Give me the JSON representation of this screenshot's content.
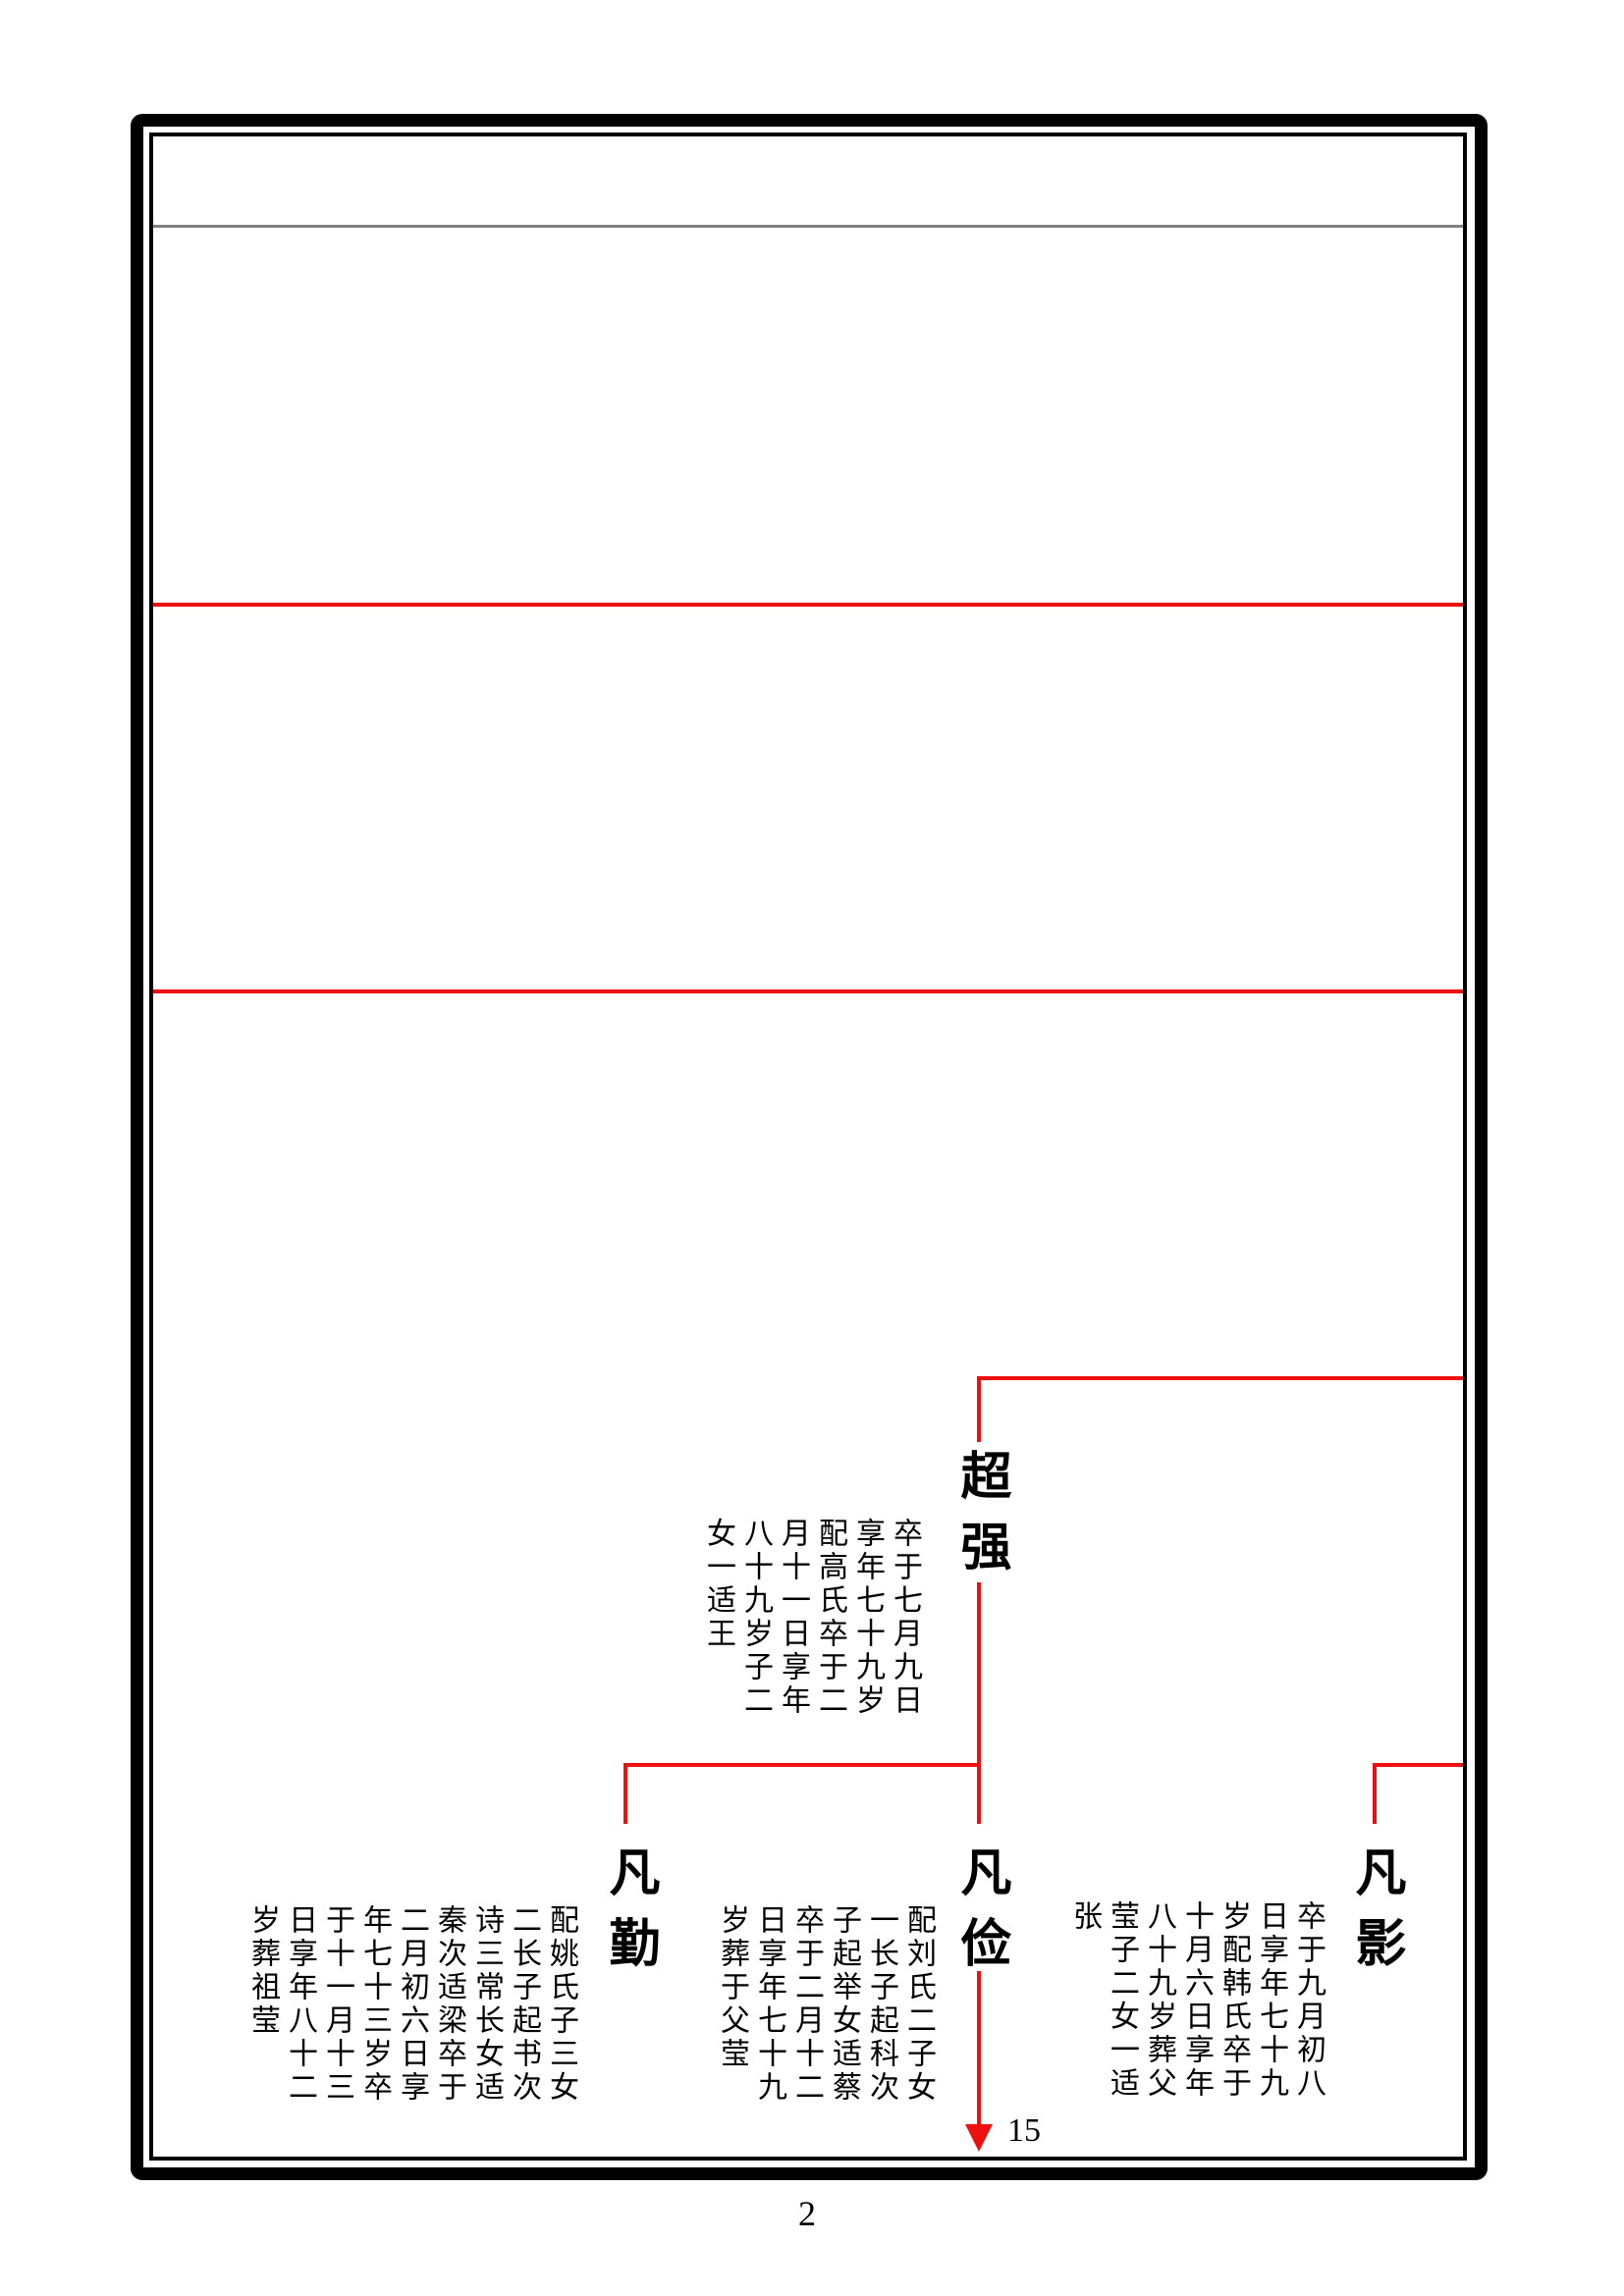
{
  "page": {
    "number": "2",
    "continuation_label": "15"
  },
  "tree": {
    "parent": {
      "name": "超强",
      "bio": "卒于七月九日享年七十九岁配高氏卒于二月十一日享年八十九岁子二女一适王"
    },
    "children": [
      {
        "name": "凡勤",
        "bio": "配姚氏子三女二长子起书次诗三常长女适秦次适梁卒于二月初六日享年七十三岁卒于十一月十三日享年八十二岁葬祖莹"
      },
      {
        "name": "凡俭",
        "bio": "配刘氏二子女一长子起科次子起举女适蔡卒于二月十二日享年七十九岁葬于父莹"
      },
      {
        "name": "凡影",
        "bio": "卒于九月初八日享年七十九岁配韩氏卒于十月六日享年八十九岁葬父莹子二女一适张"
      }
    ]
  },
  "colors": {
    "connector_red": "#ee0f0f",
    "divider_gray": "#808080",
    "frame_black": "#000000"
  }
}
